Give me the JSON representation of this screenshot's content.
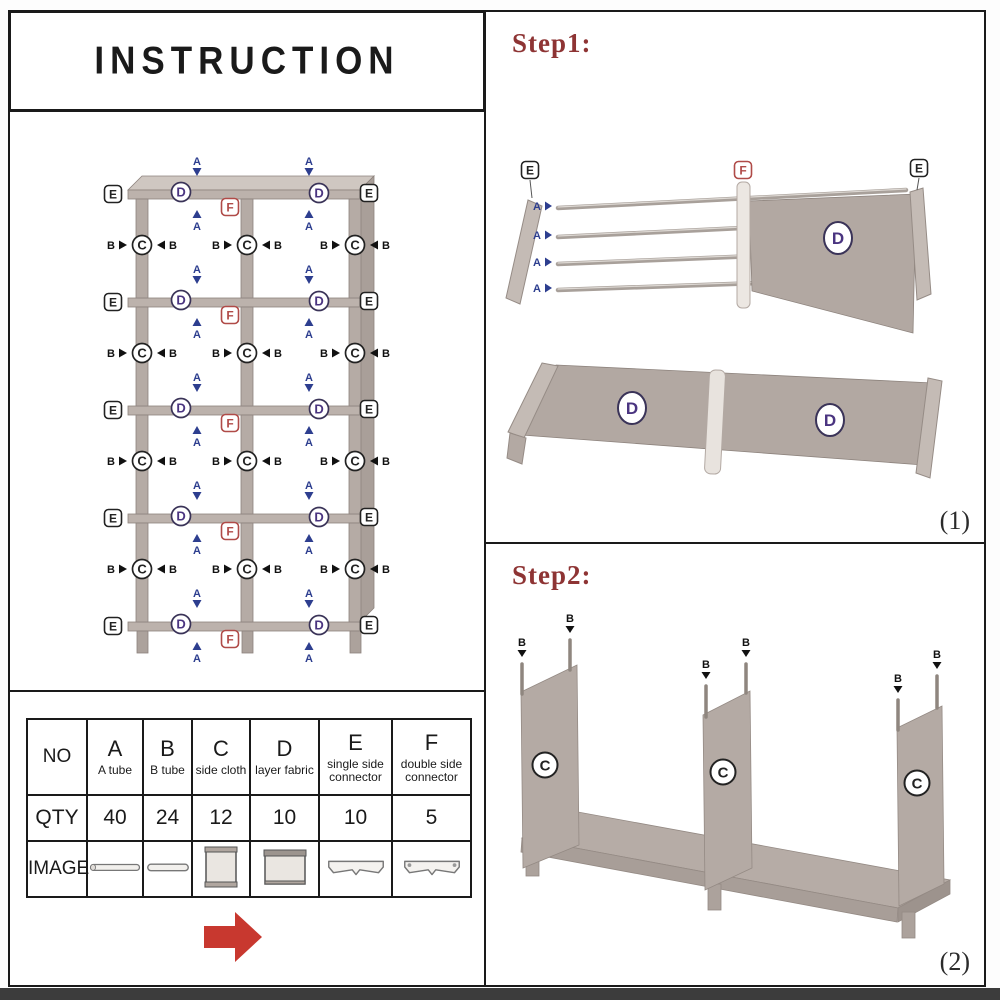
{
  "title": "INSTRUCTION",
  "labels": {
    "A": "A",
    "B": "B",
    "C": "C",
    "D": "D",
    "E": "E",
    "F": "F"
  },
  "step1": {
    "label": "Step1:",
    "figure_number": "(1)"
  },
  "step2": {
    "label": "Step2:",
    "figure_number": "(2)"
  },
  "parts_table": {
    "row_headers": {
      "no": "NO",
      "qty": "QTY",
      "image": "IMAGE"
    },
    "columns": [
      {
        "letter": "A",
        "name": "A tube",
        "qty": "40",
        "image": "long-tube"
      },
      {
        "letter": "B",
        "name": "B tube",
        "qty": "24",
        "image": "short-tube"
      },
      {
        "letter": "C",
        "name": "side cloth",
        "qty": "12",
        "image": "side-cloth-panel"
      },
      {
        "letter": "D",
        "name": "layer fabric",
        "qty": "10",
        "image": "layer-fabric-panel"
      },
      {
        "letter": "E",
        "name": "single side connector",
        "qty": "10",
        "image": "single-side-connector"
      },
      {
        "letter": "F",
        "name": "double side connector",
        "qty": "5",
        "image": "double-side-connector"
      }
    ]
  },
  "colors": {
    "red_arrow": "#c8382f",
    "step_label_red": "#8e3434",
    "label_a_blue": "#2d3e8f",
    "label_d_purple": "#4a3480",
    "label_f_red": "#b04b48",
    "shelf_taupe": "#b5aba5",
    "shelf_taupe_dark": "#8d837d",
    "shelf_taupe_light": "#cfc7c1"
  }
}
